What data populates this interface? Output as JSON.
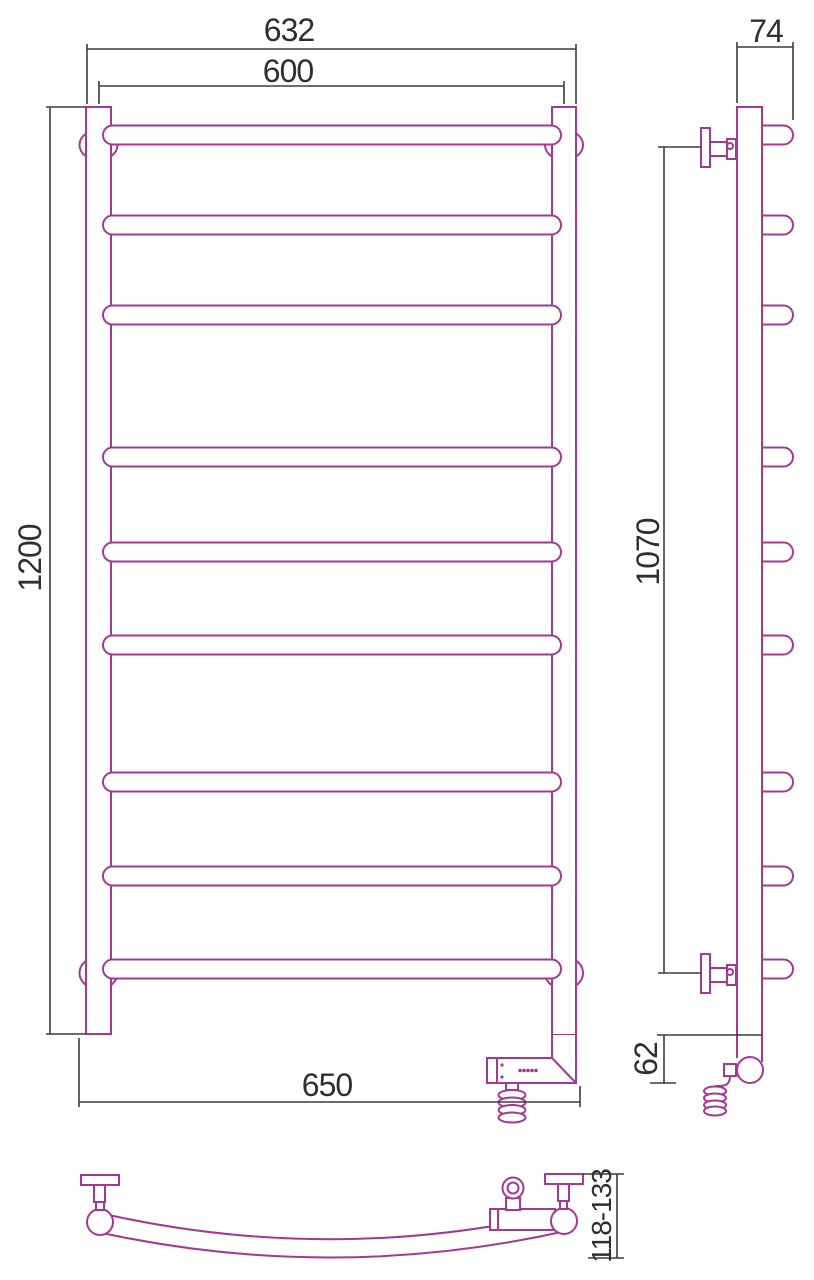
{
  "drawing": {
    "type": "technical-drawing",
    "subject": "ladder towel rail with electric heating element, three orthographic views",
    "colors": {
      "object_line": "#a63795",
      "dimension_line": "#3d3d3d",
      "dimension_text": "#2f2f2f",
      "background": "#ffffff"
    },
    "views": {
      "front": {
        "name": "front view",
        "bar_count": 9,
        "dims": {
          "overall_width": "632",
          "rail_spacing": "600",
          "overall_height": "1200",
          "bottom_width": "650"
        }
      },
      "side": {
        "name": "side view",
        "dims": {
          "depth": "74",
          "bracket_span": "1070",
          "heater_drop": "62"
        }
      },
      "bottom": {
        "name": "bottom view",
        "dims": {
          "depth_range": "118-133"
        }
      }
    }
  }
}
